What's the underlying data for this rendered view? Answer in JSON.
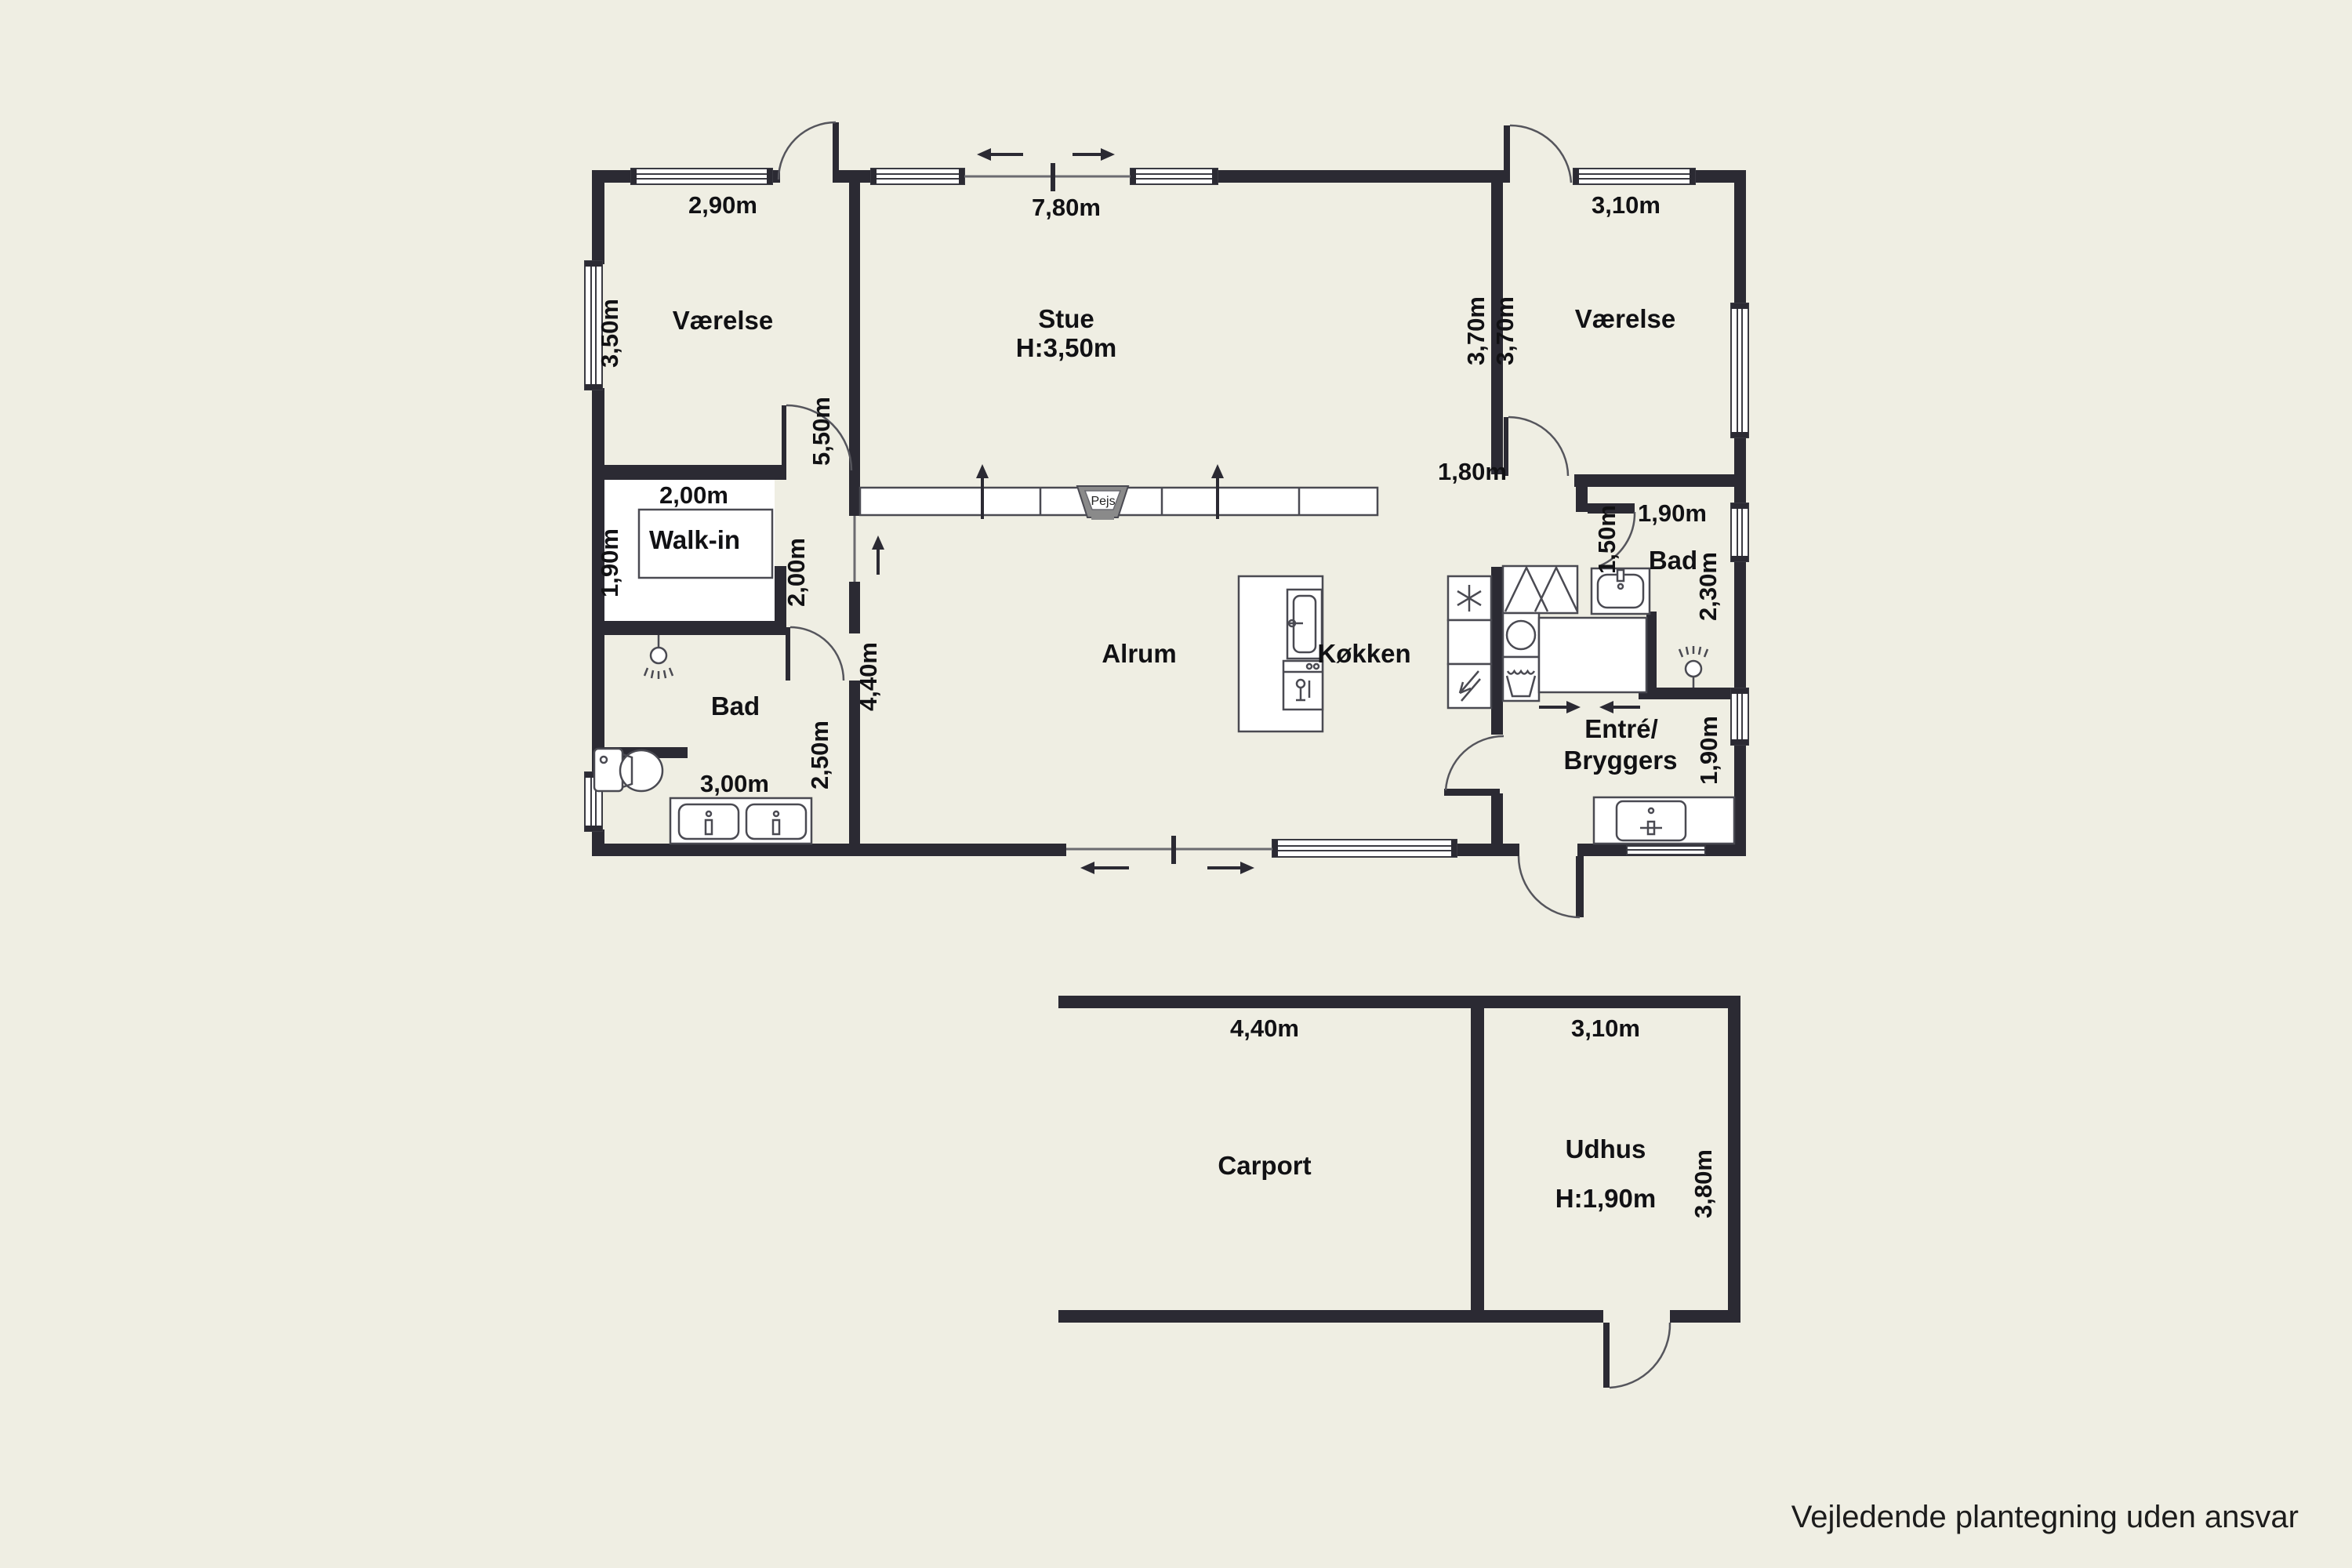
{
  "disclaimer": "Vejledende plantegning uden ansvar",
  "rooms": {
    "vaerelse_left": "Værelse",
    "stue": "Stue",
    "stue_height": "H:3,50m",
    "vaerelse_right": "Værelse",
    "walk_in": "Walk-in",
    "bad_left": "Bad",
    "alrum": "Alrum",
    "koekken": "Køkken",
    "bad_right": "Bad",
    "entre": "Entré/",
    "bryggers": "Bryggers",
    "carport": "Carport",
    "udhus": "Udhus",
    "udhus_height": "H:1,90m",
    "pejs": "Pejs"
  },
  "dimensions": {
    "vaerelse_left_width": "2,90m",
    "vaerelse_left_depth": "3,50m",
    "stue_width": "7,80m",
    "stue_depth": "3,70m",
    "vaerelse_right_width": "3,10m",
    "vaerelse_right_depth": "3,70m",
    "hall_wall": "5,50m",
    "walkin_width": "2,00m",
    "walkin_depth": "1,90m",
    "corridor_length": "2,00m",
    "stue_opening": "1,80m",
    "bad_left_width": "3,00m",
    "bad_left_depth": "2,50m",
    "alrum_depth": "4,40m",
    "hall_width": "1,50m",
    "bad_right_width": "1,90m",
    "bad_right_depth": "2,30m",
    "entre_width": "1,90m",
    "carport_width": "4,40m",
    "udhus_width": "3,10m",
    "udhus_depth": "3,80m"
  },
  "colors": {
    "background": "#EFEEE3",
    "walls": "#2B2A33",
    "fixture_stroke": "#4a4a52",
    "fireplace_gray": "#8a8a8a"
  }
}
